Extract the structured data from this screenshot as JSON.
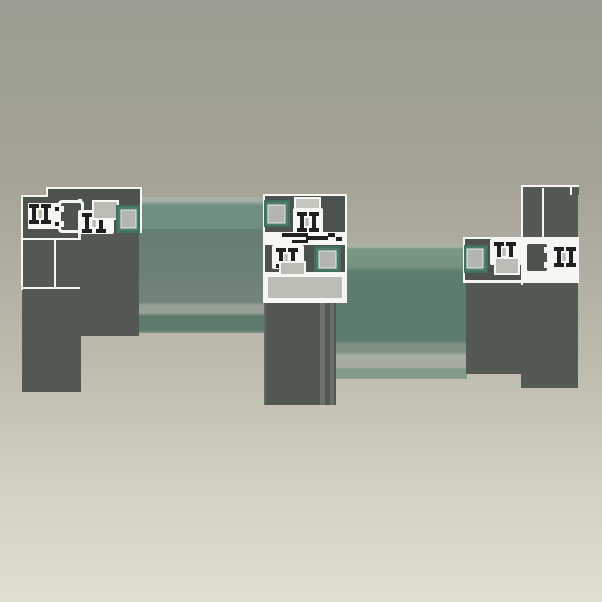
{
  "scene": {
    "title": "Sliding door profile cross-section render",
    "description": "3D CAD perspective render of a horizontal cross-section through a two-panel aluminium sliding door system: outer frame jambs at left and right, two glazed sliding sashes that overlap at a central interlock of meeting stiles. White-outlined section profiles with black brush gaskets, light-gray setting blocks and translucent green insulated glass units. No text labels are visible.",
    "components": [
      {
        "id": "left-frame-jamb",
        "label": "Left outer frame jamb profile"
      },
      {
        "id": "left-sash-stile",
        "label": "Left sash stile with glazing pocket"
      },
      {
        "id": "glass-unit-left",
        "label": "Left sash insulated glass unit"
      },
      {
        "id": "central-interlock",
        "label": "Central interlock of meeting stiles"
      },
      {
        "id": "glass-unit-right",
        "label": "Right sash insulated glass unit"
      },
      {
        "id": "right-sash-stile",
        "label": "Right sash stile with glazing pocket"
      },
      {
        "id": "right-frame-jamb",
        "label": "Right outer frame jamb profile"
      }
    ]
  },
  "colors": {
    "bg-top": "#9c9c92",
    "bg-bottom": "#e1dfd0",
    "profile-dark": "#555954",
    "profile-darker": "#4e524d",
    "outline-white": "#f6f6f3",
    "gasket-black": "#202020",
    "block-gray": "#bcbcb4",
    "glass-pocket": "#4f7d6d",
    "glass-pocket-dark": "#42705f",
    "glass-band": "#6f8e80",
    "glass-main-left": "#697e73",
    "glass-main-right": "#5e7c6d"
  }
}
